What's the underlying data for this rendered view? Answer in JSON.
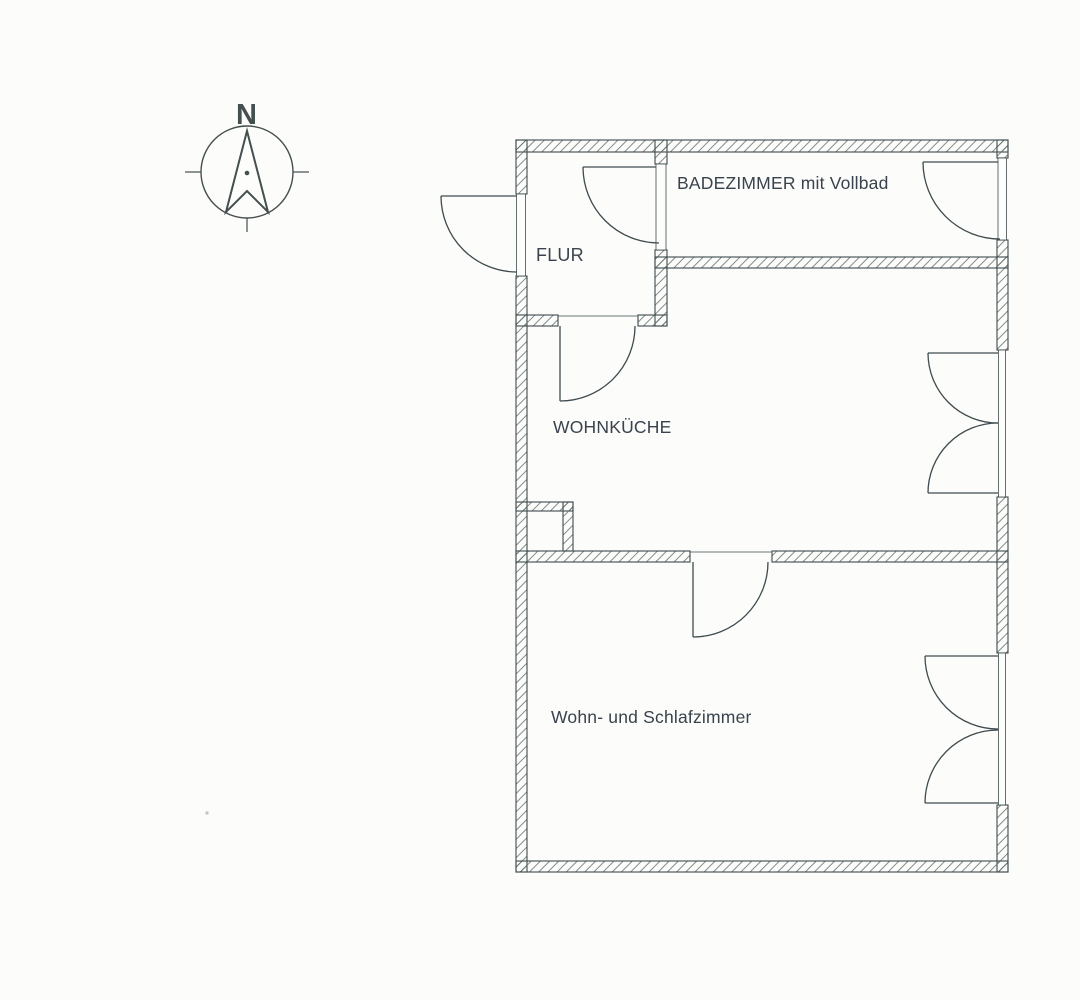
{
  "page": {
    "background": "#fcfcfa",
    "kind": "scanned architectural floor plan"
  },
  "diagram": {
    "type": "floor-plan",
    "line_color": "#3e4a4e",
    "hatch_color": "#62706c",
    "text_color": "#39434e",
    "compass": {
      "north_label": "N"
    },
    "rooms": [
      {
        "id": "badezimmer",
        "label": "BADEZIMMER mit Vollbad"
      },
      {
        "id": "flur",
        "label": "FLUR"
      },
      {
        "id": "wohnkueche",
        "label": "WOHNKÜCHE"
      },
      {
        "id": "wohn-schlafzimmer",
        "label": "Wohn- und Schlafzimmer"
      }
    ],
    "features": {
      "doors": [
        "entry-door",
        "flur-bad-door",
        "bad-exterior-door",
        "flur-kitchen-door",
        "kitchen-bedroom-door"
      ],
      "windows": [
        "kitchen-double-window",
        "bedroom-double-window"
      ],
      "shaft": "small duct shaft at left wall between kitchen and bedroom"
    }
  }
}
